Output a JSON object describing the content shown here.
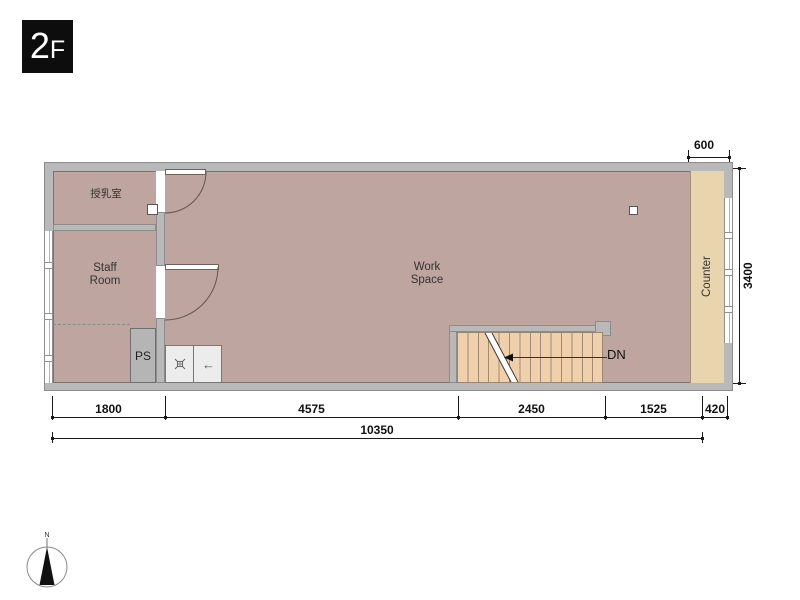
{
  "floor_badge": {
    "number": "2",
    "suffix": "F"
  },
  "rooms": {
    "nursing": {
      "label": "授乳室"
    },
    "staff": {
      "line1": "Staff",
      "line2": "Room"
    },
    "work": {
      "line1": "Work",
      "line2": "Space"
    },
    "ps": {
      "label": "PS"
    },
    "counter": {
      "label": "Counter"
    }
  },
  "stairs": {
    "dn_label": "DN",
    "tread_count": 14,
    "direction": "down-left-arrow"
  },
  "fixtures": {
    "sink_left_icon": "sink-drain",
    "sink_right_icon": "left-arrow",
    "sink_arrow": "←"
  },
  "dimensions": {
    "top": "600",
    "right": "3400",
    "bottom": [
      {
        "value": "1800"
      },
      {
        "value": "4575"
      },
      {
        "value": "2450"
      },
      {
        "value": "1525"
      },
      {
        "value": "420"
      }
    ],
    "total": "10350"
  },
  "compass": {
    "north": "N"
  },
  "colors": {
    "floor": "#bfa5a0",
    "wall": "#b9b9b9",
    "counter": "#e8d4ad",
    "stairs": "#f0d0aa",
    "badge": "#0d0d0d",
    "dimension": "#111111"
  }
}
